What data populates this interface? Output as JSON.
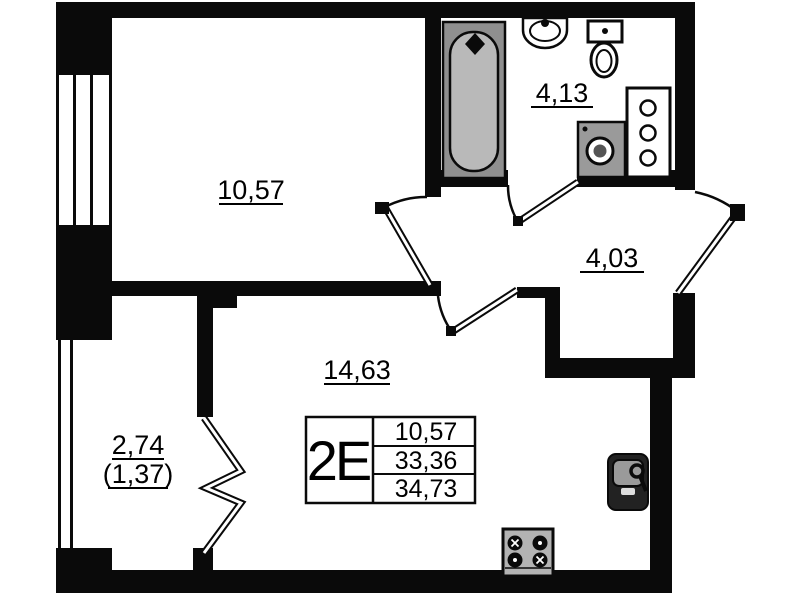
{
  "plan": {
    "rooms": {
      "bedroom": {
        "area": "10,57"
      },
      "bathroom": {
        "area": "4,13"
      },
      "hallway": {
        "area": "4,03"
      },
      "living": {
        "area": "14,63"
      },
      "balcony": {
        "area": "2,74",
        "area_coeff": "(1,37)"
      }
    },
    "info_box": {
      "unit_type": "2E",
      "living_area": "10,57",
      "floor_area": "33,36",
      "total_area": "34,73"
    },
    "colors": {
      "wall": "#0a0a0a",
      "background": "#ffffff",
      "tub_outer": "#8f8f8f",
      "tub_inner": "#b9b9b9",
      "appliance_gray": "#9a9a9a",
      "stove_gray": "#b3b3b3",
      "sink_dark": "#222222",
      "sink_basin": "#9a9a9a"
    }
  }
}
